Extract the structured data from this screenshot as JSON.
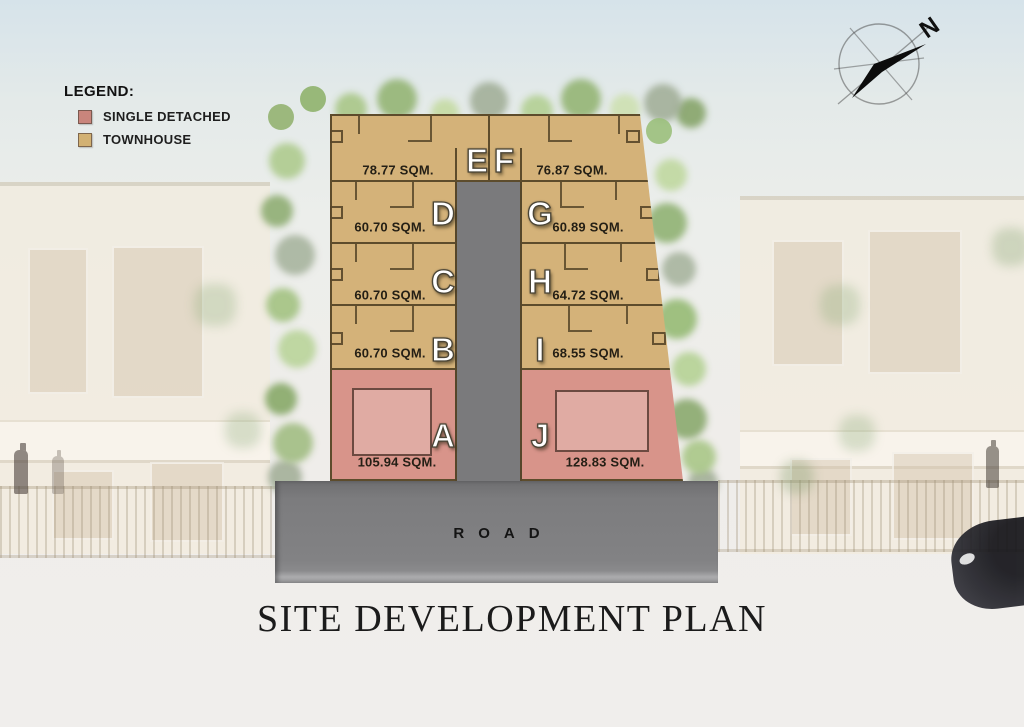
{
  "title": "SITE DEVELOPMENT PLAN",
  "legend": {
    "heading": "LEGEND:",
    "items": [
      {
        "label": "SINGLE DETACHED",
        "color": "#c9857c"
      },
      {
        "label": "TOWNHOUSE",
        "color": "#d2b173"
      }
    ]
  },
  "compass": {
    "north_label": "N"
  },
  "road": {
    "label": "ROAD"
  },
  "plan": {
    "lots": [
      {
        "id": "E",
        "area": "78.77 SQM.",
        "type": "TOWNHOUSE"
      },
      {
        "id": "F",
        "area": "76.87 SQM.",
        "type": "TOWNHOUSE"
      },
      {
        "id": "D",
        "area": "60.70 SQM.",
        "type": "TOWNHOUSE"
      },
      {
        "id": "G",
        "area": "60.89 SQM.",
        "type": "TOWNHOUSE"
      },
      {
        "id": "C",
        "area": "60.70 SQM.",
        "type": "TOWNHOUSE"
      },
      {
        "id": "H",
        "area": "64.72 SQM.",
        "type": "TOWNHOUSE"
      },
      {
        "id": "B",
        "area": "60.70 SQM.",
        "type": "TOWNHOUSE"
      },
      {
        "id": "I",
        "area": "68.55 SQM.",
        "type": "TOWNHOUSE"
      },
      {
        "id": "A",
        "area": "105.94 SQM.",
        "type": "SINGLE DETACHED"
      },
      {
        "id": "J",
        "area": "128.83 SQM.",
        "type": "SINGLE DETACHED"
      }
    ],
    "colors": {
      "townhouse": "#d4b279",
      "single_detached": "#d8948a",
      "road": "#7a7a7c"
    }
  }
}
